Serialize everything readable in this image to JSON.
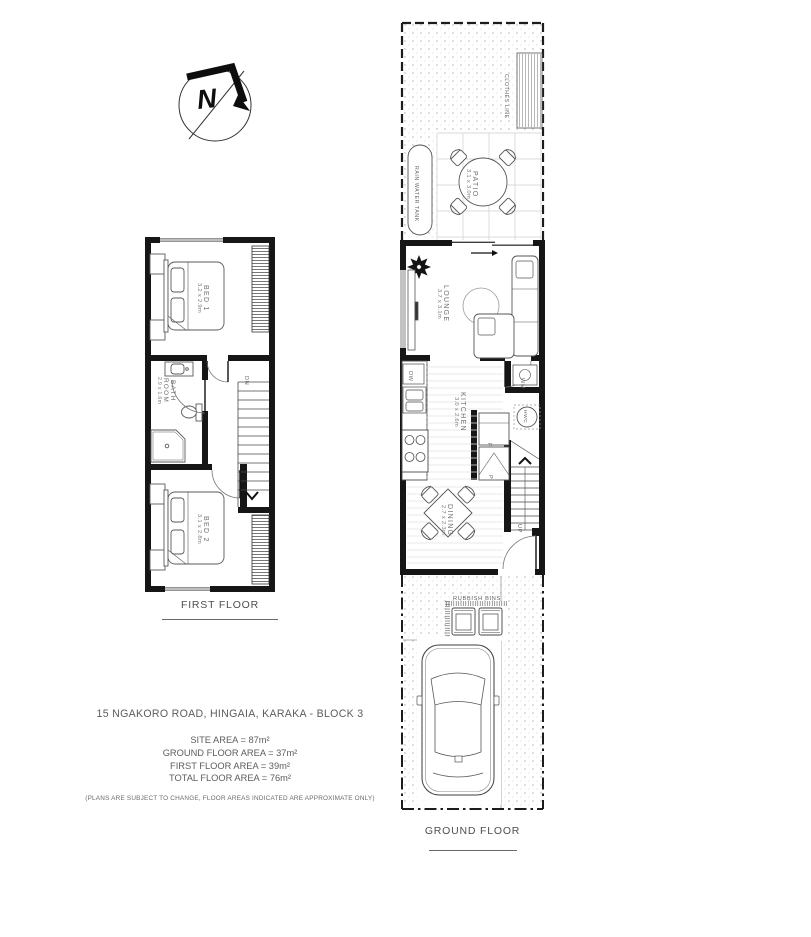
{
  "colors": {
    "wall": "#161616",
    "thin_line": "#555555",
    "label": "#6f6f6f"
  },
  "compass": {
    "north_label": "N"
  },
  "first_floor": {
    "title": "FIRST FLOOR",
    "rooms": {
      "bed1": {
        "name": "BED 1",
        "dims": "3.2 x 2.9m"
      },
      "bathroom": {
        "name": "BATH ROOM",
        "dims": "2.9 x 1.6m"
      },
      "bed2": {
        "name": "BED 2",
        "dims": "3.1 x 2.8m"
      }
    },
    "stairs_label": "DN"
  },
  "ground_floor": {
    "title": "GROUND FLOOR",
    "rooms": {
      "patio": {
        "name": "PATIO",
        "dims": "3.1 x 3.0m"
      },
      "lounge": {
        "name": "LOUNGE",
        "dims": "3.7 x 3.1m"
      },
      "kitchen": {
        "name": "KITCHEN",
        "dims": "3.0 x 2.6m"
      },
      "dining": {
        "name": "DINING",
        "dims": "2.7 x 2.3m"
      }
    },
    "labels": {
      "clothes_line": "CLOTHES LINE",
      "rain_water_tank": "RAIN WATER TANK",
      "rubbish_bins": "RUBBISH BINS",
      "dishwasher": "DW",
      "washing_machine": "WM",
      "hot_water_cylinder": "HWC",
      "fridge": "F",
      "pantry": "P",
      "stairs_label": "UP"
    }
  },
  "info": {
    "address": "15 NGAKORO ROAD, HINGAIA, KARAKA - BLOCK 3",
    "site_area": "SITE AREA = 87m²",
    "ground_floor_area": "GROUND FLOOR AREA = 37m²",
    "first_floor_area": "FIRST FLOOR AREA = 39m²",
    "total_floor_area": "TOTAL FLOOR AREA = 76m²",
    "disclaimer": "(PLANS ARE SUBJECT TO CHANGE, FLOOR AREAS INDICATED ARE APPROXIMATE ONLY)"
  }
}
